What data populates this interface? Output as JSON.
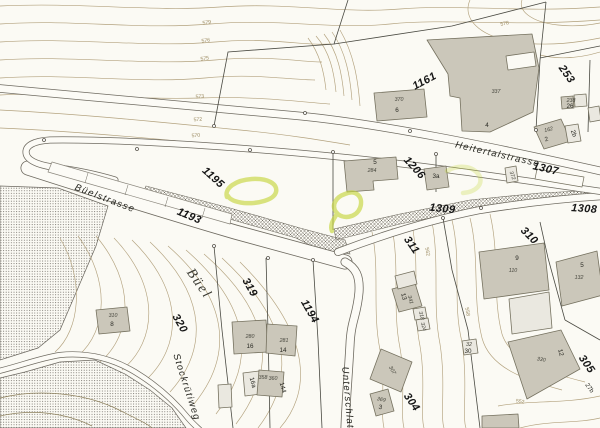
{
  "map": {
    "kind": "cadastral-plan",
    "colors": {
      "paper": "#fbfaf4",
      "contour": "#b3a27e",
      "contour_dark": "#8d805c",
      "road_casing": "#6e6a60",
      "road_fill": "#fcfbf6",
      "building_fill": "#cbc7ba",
      "building_stroke": "#75715f",
      "building_light_fill": "#eae8e0",
      "boundary": "#4a4a42",
      "hatch": "#706c62",
      "stipple": "#4f4b44",
      "highlight": "#c6d63f",
      "label_dark": "#161616",
      "label_elev": "#9b8a60"
    },
    "streets": [
      {
        "text": "Heitertalstrasse",
        "x": 497,
        "y": 157,
        "rot": 13
      },
      {
        "text": "Büelstrasse",
        "x": 104,
        "y": 201,
        "rot": 21
      },
      {
        "text": "Stockrütiweg",
        "x": 184,
        "y": 388,
        "rot": 72
      },
      {
        "text": "Unterschlatt",
        "x": 345,
        "y": 400,
        "rot": 85
      }
    ],
    "place_names": [
      {
        "text": "Büel",
        "x": 196,
        "y": 286,
        "rot": 55
      }
    ],
    "parcels": [
      {
        "text": "1161",
        "x": 426,
        "y": 84,
        "rot": -28
      },
      {
        "text": "253",
        "x": 564,
        "y": 76,
        "rot": 55
      },
      {
        "text": "1307",
        "x": 545,
        "y": 172,
        "rot": 13
      },
      {
        "text": "1206",
        "x": 412,
        "y": 170,
        "rot": 48
      },
      {
        "text": "1195",
        "x": 211,
        "y": 180,
        "rot": 42
      },
      {
        "text": "1193",
        "x": 188,
        "y": 219,
        "rot": 23
      },
      {
        "text": "1309",
        "x": 442,
        "y": 212,
        "rot": 6
      },
      {
        "text": "1308",
        "x": 584,
        "y": 212,
        "rot": 4
      },
      {
        "text": "310",
        "x": 527,
        "y": 238,
        "rot": 45
      },
      {
        "text": "311",
        "x": 409,
        "y": 247,
        "rot": 55
      },
      {
        "text": "319",
        "x": 247,
        "y": 289,
        "rot": 60
      },
      {
        "text": "320",
        "x": 177,
        "y": 325,
        "rot": 60
      },
      {
        "text": "1194",
        "x": 307,
        "y": 313,
        "rot": 60
      },
      {
        "text": "304",
        "x": 409,
        "y": 404,
        "rot": 55
      },
      {
        "text": "305",
        "x": 584,
        "y": 366,
        "rot": 55
      }
    ],
    "buildings": [
      {
        "text": "370",
        "x": 399,
        "y": 101,
        "kind": "ins"
      },
      {
        "text": "6",
        "x": 397,
        "y": 112,
        "kind": "house"
      },
      {
        "text": "337",
        "x": 496,
        "y": 93,
        "kind": "ins"
      },
      {
        "text": "4",
        "x": 487,
        "y": 127,
        "kind": "house"
      },
      {
        "text": "162",
        "x": 549,
        "y": 131,
        "kind": "ins",
        "rot": -15
      },
      {
        "text": "2",
        "x": 547,
        "y": 141,
        "kind": "house",
        "rot": -15
      },
      {
        "text": "238",
        "x": 571,
        "y": 102,
        "kind": "ins"
      },
      {
        "text": "26",
        "x": 570,
        "y": 108,
        "kind": "house"
      },
      {
        "text": "2b",
        "x": 572,
        "y": 134,
        "kind": "house",
        "rot": 70
      },
      {
        "text": "5",
        "x": 375,
        "y": 164,
        "kind": "house"
      },
      {
        "text": "284",
        "x": 372,
        "y": 172,
        "kind": "ins"
      },
      {
        "text": "3a",
        "x": 436,
        "y": 178,
        "kind": "house"
      },
      {
        "text": "372",
        "x": 511,
        "y": 176,
        "kind": "ins",
        "rot": 70
      },
      {
        "text": "310",
        "x": 113,
        "y": 317,
        "kind": "ins"
      },
      {
        "text": "8",
        "x": 112,
        "y": 326,
        "kind": "house"
      },
      {
        "text": "280",
        "x": 250,
        "y": 338,
        "kind": "ins"
      },
      {
        "text": "16",
        "x": 250,
        "y": 348,
        "kind": "house"
      },
      {
        "text": "281",
        "x": 284,
        "y": 342,
        "kind": "ins"
      },
      {
        "text": "14",
        "x": 283,
        "y": 352,
        "kind": "house"
      },
      {
        "text": "16a",
        "x": 251,
        "y": 383,
        "kind": "house",
        "rot": 75
      },
      {
        "text": "358",
        "x": 263,
        "y": 379,
        "kind": "ins"
      },
      {
        "text": "360",
        "x": 273,
        "y": 380,
        "kind": "ins"
      },
      {
        "text": "144",
        "x": 281,
        "y": 388,
        "kind": "house",
        "rot": 75
      },
      {
        "text": "369",
        "x": 381,
        "y": 401,
        "kind": "ins",
        "rot": 12
      },
      {
        "text": "3",
        "x": 380,
        "y": 409,
        "kind": "house",
        "rot": 12
      },
      {
        "text": "307",
        "x": 391,
        "y": 371,
        "kind": "ins",
        "rot": 60
      },
      {
        "text": "13",
        "x": 402,
        "y": 297,
        "kind": "house",
        "rot": 75
      },
      {
        "text": "341",
        "x": 409,
        "y": 300,
        "kind": "ins",
        "rot": 75
      },
      {
        "text": "318",
        "x": 420,
        "y": 316,
        "kind": "ins",
        "rot": 75
      },
      {
        "text": "324",
        "x": 422,
        "y": 327,
        "kind": "ins",
        "rot": 75
      },
      {
        "text": "32",
        "x": 469,
        "y": 346,
        "kind": "ins"
      },
      {
        "text": "30",
        "x": 468,
        "y": 353,
        "kind": "house"
      },
      {
        "text": "9",
        "x": 517,
        "y": 260,
        "kind": "house"
      },
      {
        "text": "110",
        "x": 513,
        "y": 272,
        "kind": "ins"
      },
      {
        "text": "5",
        "x": 582,
        "y": 267,
        "kind": "house"
      },
      {
        "text": "132",
        "x": 579,
        "y": 279,
        "kind": "ins"
      },
      {
        "text": "330",
        "x": 541,
        "y": 361,
        "kind": "ins",
        "rot": 10
      },
      {
        "text": "12",
        "x": 559,
        "y": 353,
        "kind": "house",
        "rot": 75
      },
      {
        "text": "27b",
        "x": 588,
        "y": 389,
        "kind": "house",
        "rot": 55
      }
    ],
    "contour_elevations": [
      {
        "text": "579",
        "x": 207,
        "y": 24,
        "rot": -8
      },
      {
        "text": "576",
        "x": 206,
        "y": 42,
        "rot": -8
      },
      {
        "text": "575",
        "x": 205,
        "y": 60,
        "rot": -8
      },
      {
        "text": "578",
        "x": 505,
        "y": 25,
        "rot": -12
      },
      {
        "text": "573",
        "x": 200,
        "y": 98,
        "rot": -5
      },
      {
        "text": "572",
        "x": 198,
        "y": 121,
        "rot": -5
      },
      {
        "text": "570",
        "x": 196,
        "y": 137,
        "rot": -5
      },
      {
        "text": "562",
        "x": 426,
        "y": 252,
        "rot": 80
      },
      {
        "text": "558",
        "x": 466,
        "y": 312,
        "rot": 80
      },
      {
        "text": "552",
        "x": 520,
        "y": 403,
        "rot": 8
      }
    ]
  }
}
